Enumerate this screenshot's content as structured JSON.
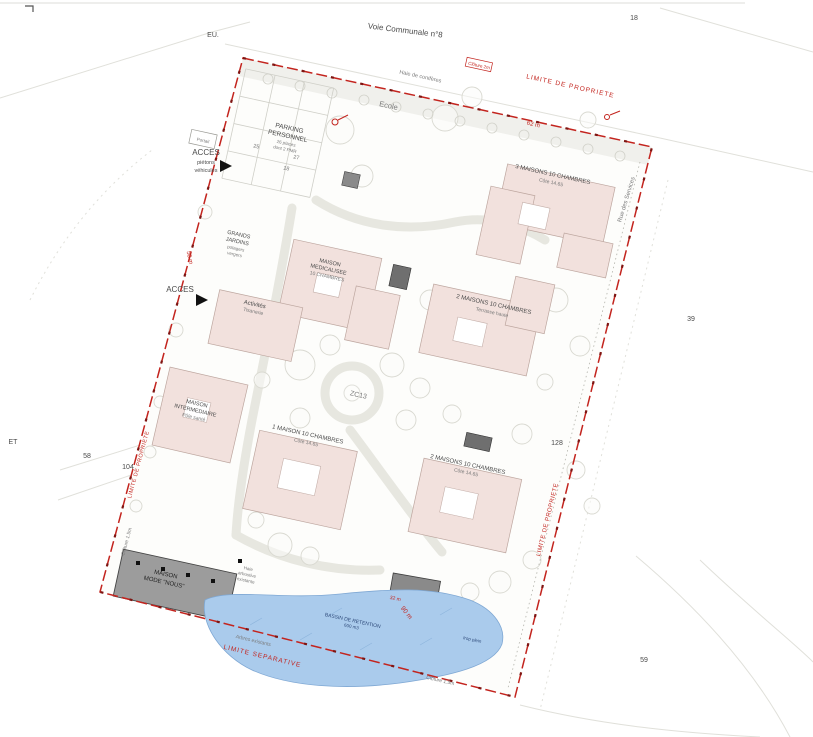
{
  "colors": {
    "boundary_red": "#c3241e",
    "building_pink": "#f2e1dd",
    "building_gray": "#9c9c9c",
    "pond_blue": "#aacbec",
    "text_gray": "#4a4a4a"
  },
  "plan": {
    "roads": {
      "voie_communale": "Voie Communale n°8",
      "rue_services": "Rue des Services"
    },
    "parcels": {
      "p18": "18",
      "p39": "39",
      "p58": "58",
      "p59": "59",
      "p104": "104",
      "p128": "128",
      "pET": "ET",
      "pEU": "EU.",
      "zc": "ZC13"
    },
    "boundary": {
      "limite_top": "LIMITE DE PROPRIETE",
      "limite_left": "LIMITE DE PROPRIETE",
      "limite_right": "LIMITE DE PROPRIETE",
      "limite_bottom": "LIMITE SEPARATIVE"
    },
    "dims": {
      "d50": "50 m",
      "d62": "62 m",
      "d90": "90 m",
      "d32": "32 m"
    },
    "labels": {
      "acces_1": "ACCES",
      "acces_2": "piétons",
      "acces_3": "véhicules",
      "acces_sud": "ACCES",
      "parking_1": "PARKING",
      "parking_2": "PERSONNEL",
      "parking_3": "26 places",
      "parking_4": "dont 2 PMR",
      "stall_a": "25",
      "stall_b": "27",
      "stall_c": "18",
      "ecole": "Ecole",
      "jardins_1": "GRANDS",
      "jardins_2": "JARDINS",
      "jardins_3": "potagers",
      "jardins_4": "vergers",
      "m_tr_1": "3 MAISONS 10 CHAMBRES",
      "m_tr_2": "Côte 14.65",
      "m_ml_1": "MAISON",
      "m_ml_2": "MEDICALISEE",
      "m_ml_3": "10 CHAMBRES",
      "m_mr_1": "2 MAISONS 10 CHAMBRES",
      "m_mr_2": "Terrasse haute",
      "activites_1": "Activités",
      "activites_2": "Tisanerie",
      "m_int_1": "MAISON",
      "m_int_2": "INTERMEDIAIRE",
      "m_int_3": "Pôle santé",
      "m_bl_1": "1 MAISON 10 CHAMBRES",
      "m_bl_2": "Côte 14.65",
      "m_br_1": "2 MAISONS 10 CHAMBRES",
      "m_br_2": "Côte 14.65",
      "maison_nous_1": "MAISON",
      "maison_nous_2": "MODE \"NOUS\"",
      "bassin_1": "BASSIN DE RETENTION",
      "bassin_2": "600 m3",
      "trop_plein": "trop plein",
      "haie_1": "Haie",
      "haie_2": "arbustive",
      "haie_3": "existante",
      "haie_conifere": "Haie de conifères",
      "cloture_2m": "Clôture 2m",
      "portail": "Portail",
      "arbres_exist": "Arbres existants",
      "cloture_15_b": "Clôture 1.5m",
      "cloture_15_l": "Clôture 1.5m"
    }
  }
}
